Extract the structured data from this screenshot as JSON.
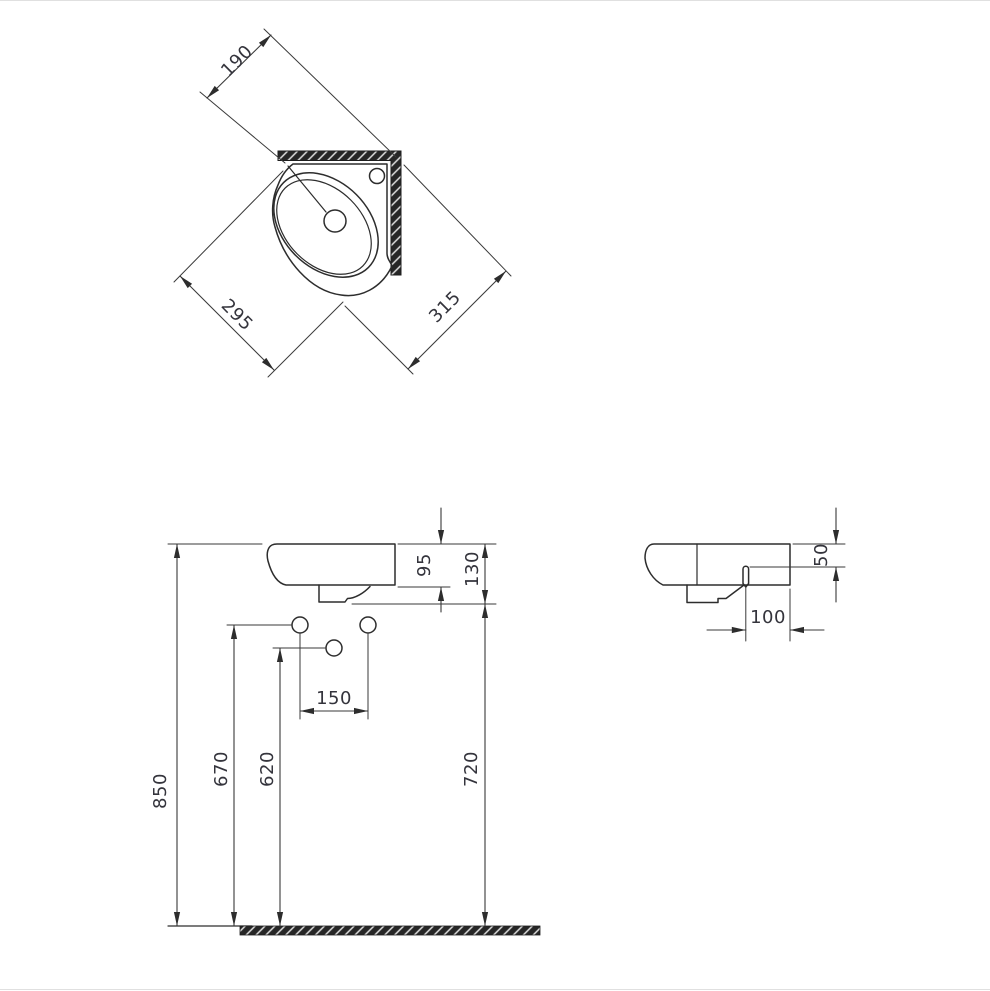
{
  "document": {
    "type": "technical dimension drawing",
    "subject": "corner wall-hung washbasin, three orthographic views, dimensions in mm"
  },
  "colors": {
    "background": "#ffffff",
    "line": "#2d2d2d",
    "text": "#34343c",
    "solid_fill": "#262626"
  },
  "views": {
    "top": {
      "name": "plan view",
      "dims": {
        "back_width": "190",
        "left_edge": "295",
        "right_edge": "315"
      }
    },
    "front": {
      "name": "front elevation",
      "dims": {
        "rim_to_body": "95",
        "rim_to_apron": "130",
        "hole_spacing": "150",
        "middle_hole_height": "620",
        "side_hole_height": "670",
        "apron_height": "720",
        "rim_height": "850"
      }
    },
    "side": {
      "name": "side elevation",
      "dims": {
        "slot_below_rim": "50",
        "slot_to_wall": "100"
      }
    }
  }
}
